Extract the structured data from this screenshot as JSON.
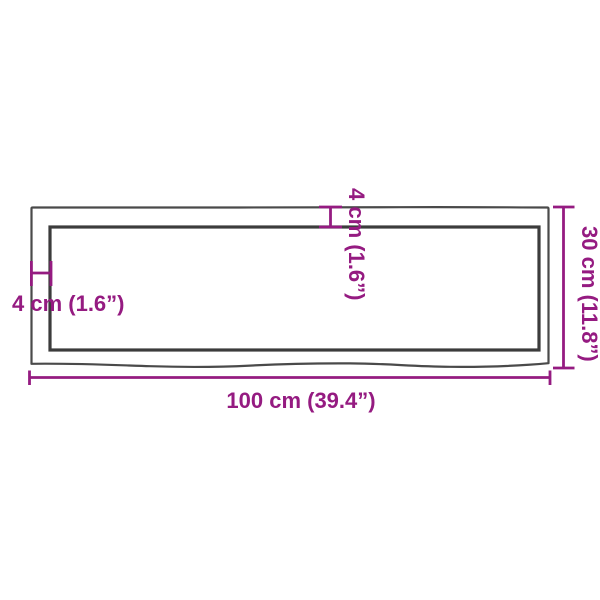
{
  "product_diagram": {
    "kind": "product-dimension-diagram",
    "subject": "wall-shelf-top-with-live-edge",
    "annotations": {
      "width": {
        "label": "100 cm (39.4”)",
        "value_cm": 100,
        "value_in": 39.4
      },
      "height": {
        "label": "30 cm (11.8”)",
        "value_cm": 30,
        "value_in": 11.8
      },
      "top_thickness": {
        "label": "4 cm (1.6”)",
        "value_cm": 4,
        "value_in": 1.6
      },
      "left_thickness": {
        "label": "4 cm (1.6”)",
        "value_cm": 4,
        "value_in": 1.6
      }
    },
    "colors": {
      "accent": "#951b81",
      "outline_outer": "#4a4a4a",
      "outline_inner": "#3c3c3c",
      "background": "#ffffff"
    }
  }
}
